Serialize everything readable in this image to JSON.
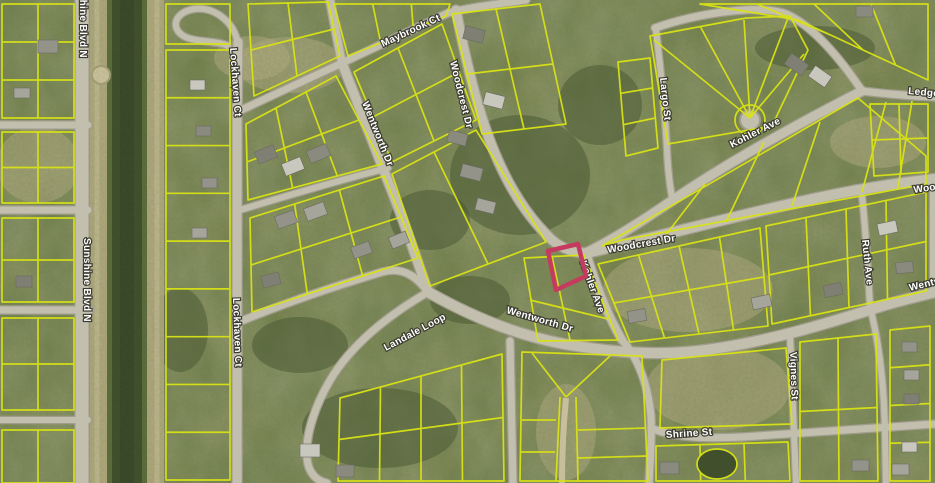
{
  "map": {
    "title": "Aerial parcel map with highlighted lot",
    "street_labels": [
      {
        "text": "Sunshine Blvd N",
        "x": 80,
        "y": -26,
        "rot": 90
      },
      {
        "text": "Lockhaven Ct",
        "x": 230,
        "y": 48,
        "rot": 86
      },
      {
        "text": "Maybrook Ct",
        "x": 383,
        "y": 47,
        "rot": -25
      },
      {
        "text": "Wentworth Dr",
        "x": 362,
        "y": 103,
        "rot": 68
      },
      {
        "text": "Woodcrest Dr",
        "x": 450,
        "y": 62,
        "rot": 76
      },
      {
        "text": "Kohler Ave",
        "x": 732,
        "y": 148,
        "rot": -27
      },
      {
        "text": "Ledgew",
        "x": 908,
        "y": 94,
        "rot": 5
      },
      {
        "text": "Largo St",
        "x": 660,
        "y": 78,
        "rot": 84
      },
      {
        "text": "Woodcrest Dr",
        "x": 608,
        "y": 253,
        "rot": -10
      },
      {
        "text": "Wood",
        "x": 914,
        "y": 193,
        "rot": -8
      },
      {
        "text": "Kohler Ave",
        "x": 580,
        "y": 262,
        "rot": 70
      },
      {
        "text": "Sunshine Blvd N",
        "x": 84,
        "y": 238,
        "rot": 90
      },
      {
        "text": "Lockhaven Ct",
        "x": 233,
        "y": 298,
        "rot": 88
      },
      {
        "text": "Wentworth Dr",
        "x": 506,
        "y": 313,
        "rot": 16
      },
      {
        "text": "Landale Loop",
        "x": 386,
        "y": 351,
        "rot": -28
      },
      {
        "text": "Wentw",
        "x": 910,
        "y": 291,
        "rot": -14
      },
      {
        "text": "Ruth Ave",
        "x": 862,
        "y": 240,
        "rot": 84
      },
      {
        "text": "Vignes St",
        "x": 790,
        "y": 352,
        "rot": 88
      },
      {
        "text": "Shrine St",
        "x": 666,
        "y": 438,
        "rot": -4
      }
    ],
    "highlighted_parcel": {
      "points": "548,251 578,244 586,276 556,290",
      "color": "#c53b60"
    },
    "colors": {
      "vegetation_base": "#77814c",
      "tree_dark": "#455430",
      "dry_grass": "#b6ae84",
      "parcel_line": "#d8e215",
      "road_fill": "#c3bfae",
      "road_casing": "#a19d8e",
      "canal_water": "#3e4d2a",
      "canal_corridor": "#b2aa80",
      "label_fill": "#ffffff",
      "label_halo": "#3c3c30"
    }
  }
}
